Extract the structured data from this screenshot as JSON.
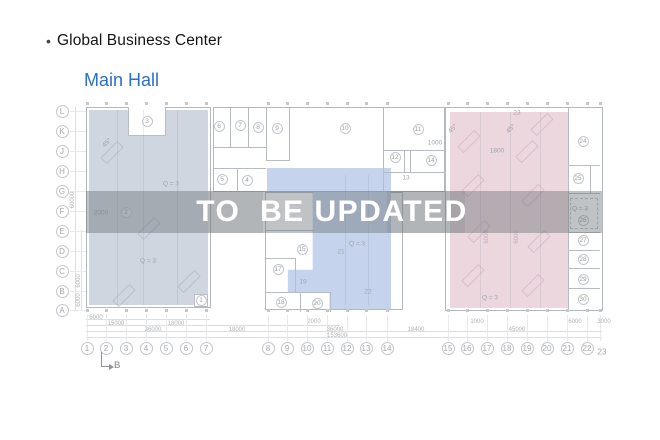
{
  "header": {
    "bullet": "•",
    "title": "Global Business Center",
    "subtitle": "Main Hall"
  },
  "watermark": {
    "text": "TO  BE UPDATED"
  },
  "colors": {
    "accent": "#2b6fc7",
    "left_fill": "#d0d6df",
    "middle_fill": "#c5d4ec",
    "right_fill": "#ecd7df",
    "band": "rgba(106,111,116,0.42)",
    "watermark": "#ffffff",
    "wall": "#b3b8bd"
  },
  "plan": {
    "section_marker": "B",
    "row_labels": [
      {
        "label": "L",
        "x": 62,
        "y": 111
      },
      {
        "label": "K",
        "x": 62,
        "y": 131
      },
      {
        "label": "J",
        "x": 62,
        "y": 151
      },
      {
        "label": "H",
        "x": 62,
        "y": 171
      },
      {
        "label": "G",
        "x": 62,
        "y": 191
      },
      {
        "label": "F",
        "x": 62,
        "y": 211
      },
      {
        "label": "E",
        "x": 62,
        "y": 231
      },
      {
        "label": "D",
        "x": 62,
        "y": 251
      },
      {
        "label": "C",
        "x": 62,
        "y": 271
      },
      {
        "label": "B",
        "x": 62,
        "y": 291
      },
      {
        "label": "A",
        "x": 62,
        "y": 310
      }
    ],
    "col_labels": [
      {
        "label": "1",
        "x": 87,
        "y": 348
      },
      {
        "label": "2",
        "x": 106,
        "y": 348
      },
      {
        "label": "3",
        "x": 126,
        "y": 348
      },
      {
        "label": "4",
        "x": 146,
        "y": 348
      },
      {
        "label": "5",
        "x": 166,
        "y": 348
      },
      {
        "label": "6",
        "x": 186,
        "y": 348
      },
      {
        "label": "7",
        "x": 206,
        "y": 348
      },
      {
        "label": "8",
        "x": 268,
        "y": 348
      },
      {
        "label": "9",
        "x": 287,
        "y": 348
      },
      {
        "label": "10",
        "x": 307,
        "y": 348
      },
      {
        "label": "11",
        "x": 327,
        "y": 348
      },
      {
        "label": "12",
        "x": 347,
        "y": 348
      },
      {
        "label": "13",
        "x": 366,
        "y": 348
      },
      {
        "label": "14",
        "x": 387,
        "y": 348
      },
      {
        "label": "15",
        "x": 448,
        "y": 348
      },
      {
        "label": "16",
        "x": 467,
        "y": 348
      },
      {
        "label": "17",
        "x": 487,
        "y": 348
      },
      {
        "label": "18",
        "x": 507,
        "y": 348
      },
      {
        "label": "19",
        "x": 527,
        "y": 348
      },
      {
        "label": "20",
        "x": 547,
        "y": 348
      },
      {
        "label": "21",
        "x": 567,
        "y": 348
      },
      {
        "label": "22",
        "x": 587,
        "y": 348
      },
      {
        "label": "23",
        "x": 602,
        "y": 352,
        "plain": true
      }
    ],
    "rooms": [
      {
        "n": "3",
        "x": 147,
        "y": 121
      },
      {
        "n": "2",
        "x": 126,
        "y": 212
      },
      {
        "n": "1",
        "x": 201,
        "y": 300
      },
      {
        "n": "6",
        "x": 219,
        "y": 126
      },
      {
        "n": "7",
        "x": 240,
        "y": 125
      },
      {
        "n": "8",
        "x": 258,
        "y": 127
      },
      {
        "n": "9",
        "x": 277,
        "y": 128
      },
      {
        "n": "10",
        "x": 345,
        "y": 128
      },
      {
        "n": "11",
        "x": 418,
        "y": 129
      },
      {
        "n": "5",
        "x": 222,
        "y": 179
      },
      {
        "n": "4",
        "x": 247,
        "y": 180
      },
      {
        "n": "12",
        "x": 395,
        "y": 157
      },
      {
        "n": "14",
        "x": 431,
        "y": 160
      },
      {
        "n": "15",
        "x": 302,
        "y": 249
      },
      {
        "n": "17",
        "x": 278,
        "y": 269
      },
      {
        "n": "18",
        "x": 281,
        "y": 302
      },
      {
        "n": "20",
        "x": 317,
        "y": 303
      },
      {
        "n": "24",
        "x": 583,
        "y": 141
      },
      {
        "n": "25",
        "x": 578,
        "y": 178
      },
      {
        "n": "26",
        "x": 583,
        "y": 220
      },
      {
        "n": "27",
        "x": 583,
        "y": 240
      },
      {
        "n": "28",
        "x": 583,
        "y": 259
      },
      {
        "n": "29",
        "x": 583,
        "y": 279
      },
      {
        "n": "30",
        "x": 583,
        "y": 299
      }
    ],
    "plain_labels": [
      {
        "t": "13",
        "x": 406,
        "y": 178
      },
      {
        "t": "19",
        "x": 303,
        "y": 282
      },
      {
        "t": "21",
        "x": 341,
        "y": 252
      },
      {
        "t": "22",
        "x": 368,
        "y": 292
      },
      {
        "t": "23",
        "x": 517,
        "y": 113
      },
      {
        "t": "Q = 3",
        "x": 357,
        "y": 244
      },
      {
        "t": "Q = 3",
        "x": 171,
        "y": 184
      },
      {
        "t": "Q = 3",
        "x": 148,
        "y": 261
      },
      {
        "t": "Q = 3",
        "x": 490,
        "y": 298
      },
      {
        "t": "Q = 3",
        "x": 580,
        "y": 209
      },
      {
        "t": "1800",
        "x": 497,
        "y": 151
      },
      {
        "t": "1000",
        "x": 435,
        "y": 143
      },
      {
        "t": "2000",
        "x": 101,
        "y": 213
      },
      {
        "t": "45°",
        "x": 453,
        "y": 129,
        "rot": -45
      },
      {
        "t": "45°",
        "x": 511,
        "y": 129,
        "rot": -45
      },
      {
        "t": "45°",
        "x": 107,
        "y": 143,
        "rot": -45
      }
    ],
    "vdims": [
      {
        "t": "60000",
        "x": 73,
        "y": 200
      },
      {
        "t": "6000",
        "x": 79,
        "y": 281
      },
      {
        "t": "6000",
        "x": 79,
        "y": 300
      },
      {
        "t": "6000",
        "x": 487,
        "y": 237,
        "c": "#c3a8b4"
      },
      {
        "t": "6000",
        "x": 517,
        "y": 237,
        "c": "#c3a8b4"
      }
    ],
    "dims": [
      {
        "t": "6000",
        "x": 96,
        "y": 315
      },
      {
        "t": "15000",
        "x": 116,
        "y": 321
      },
      {
        "t": "18000",
        "x": 176,
        "y": 321
      },
      {
        "t": "2000",
        "x": 314,
        "y": 319
      },
      {
        "t": "1000",
        "x": 477,
        "y": 319
      },
      {
        "t": "6000",
        "x": 575,
        "y": 319
      },
      {
        "t": "3000",
        "x": 604,
        "y": 319
      },
      {
        "t": "36000",
        "x": 153,
        "y": 327
      },
      {
        "t": "18000",
        "x": 237,
        "y": 327
      },
      {
        "t": "36000",
        "x": 335,
        "y": 327
      },
      {
        "t": "18400",
        "x": 416,
        "y": 327
      },
      {
        "t": "45000",
        "x": 517,
        "y": 327
      },
      {
        "t": "153600",
        "x": 337,
        "y": 333
      }
    ]
  }
}
